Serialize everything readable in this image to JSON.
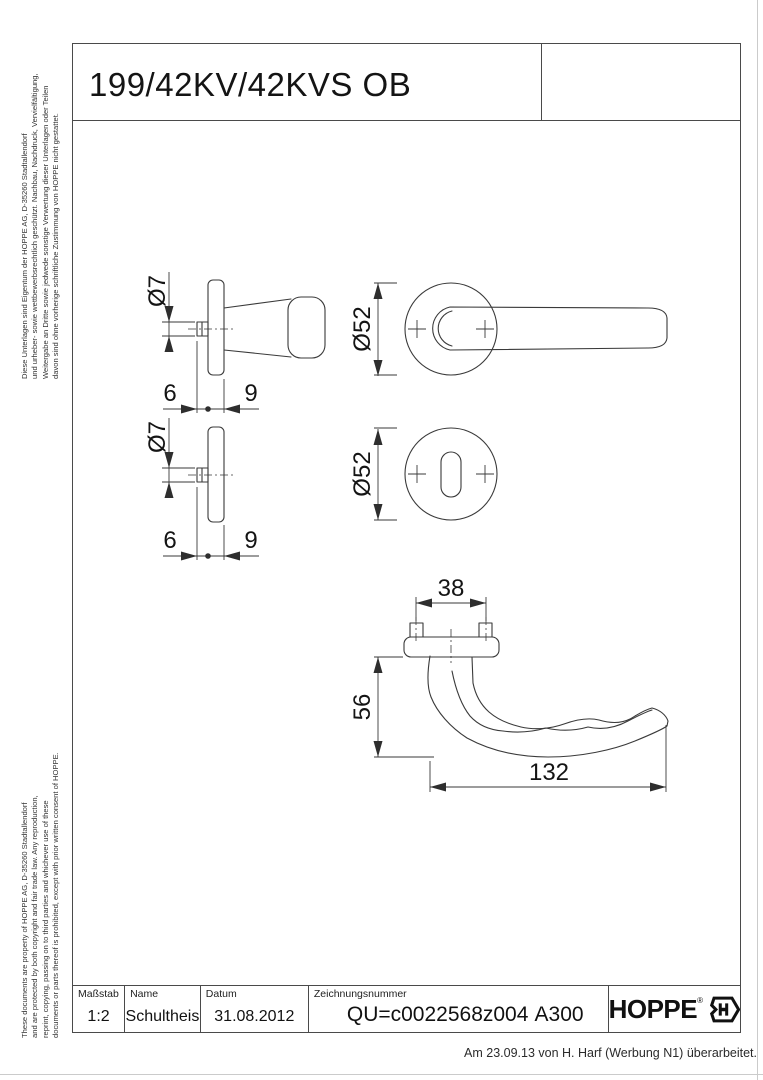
{
  "page": {
    "title": "199/42KV/42KVS OB",
    "footer_note": "Am 23.09.13 von H. Harf (Werbung N1) überarbeitet."
  },
  "legal": {
    "german_lines": [
      "Diese Unterlagen sind Eigentum der  HOPPE AG, D-35260 Stadtallendorf",
      "und urheber- sowie wettbewerbsrechtlich geschützt. Nachbau, Nachdruck, Vervielfältigung,",
      "Weitergabe an Dritte sowie jedwede sonstige Verwertung dieser Unterlagen oder Teilen",
      "davon sind ohne vorherige schriftliche Zustimmung von HOPPE nicht gestattet."
    ],
    "english_lines": [
      "These documents are property of  HOPPE AG, D-35260 Stadtallendorf",
      "and are protected by both copyright and fair trade law. Any reproduction,",
      "reprint, copying, passing on to third parties and whichever use of these",
      "documents or parts thereof is prohibited, except with prior written consent of  HOPPE."
    ]
  },
  "views": {
    "handle_side": {
      "dims": {
        "pin_dia": "Ø7",
        "d6": "6",
        "d9": "9"
      }
    },
    "handle_front": {
      "dims": {
        "rose_dia": "Ø52"
      }
    },
    "rose_side": {
      "dims": {
        "pin_dia": "Ø7",
        "d6": "6",
        "d9": "9"
      }
    },
    "rose_front": {
      "dims": {
        "rose_dia": "Ø52"
      }
    },
    "handle_top": {
      "dims": {
        "d38": "38",
        "d56": "56",
        "d132": "132"
      }
    }
  },
  "title_block": {
    "scale_label": "Maßstab",
    "scale_value": "1:2",
    "name_label": "Name",
    "name_value": "Schultheis",
    "date_label": "Datum",
    "date_value": "31.08.2012",
    "drawing_no_label": "Zeichnungsnummer",
    "drawing_no_value": "QU=c0022568z004",
    "revision_code": "A300",
    "brand_name": "HOPPE"
  },
  "colors": {
    "line": "#3a3a3a",
    "frame": "#4a4a4a"
  }
}
